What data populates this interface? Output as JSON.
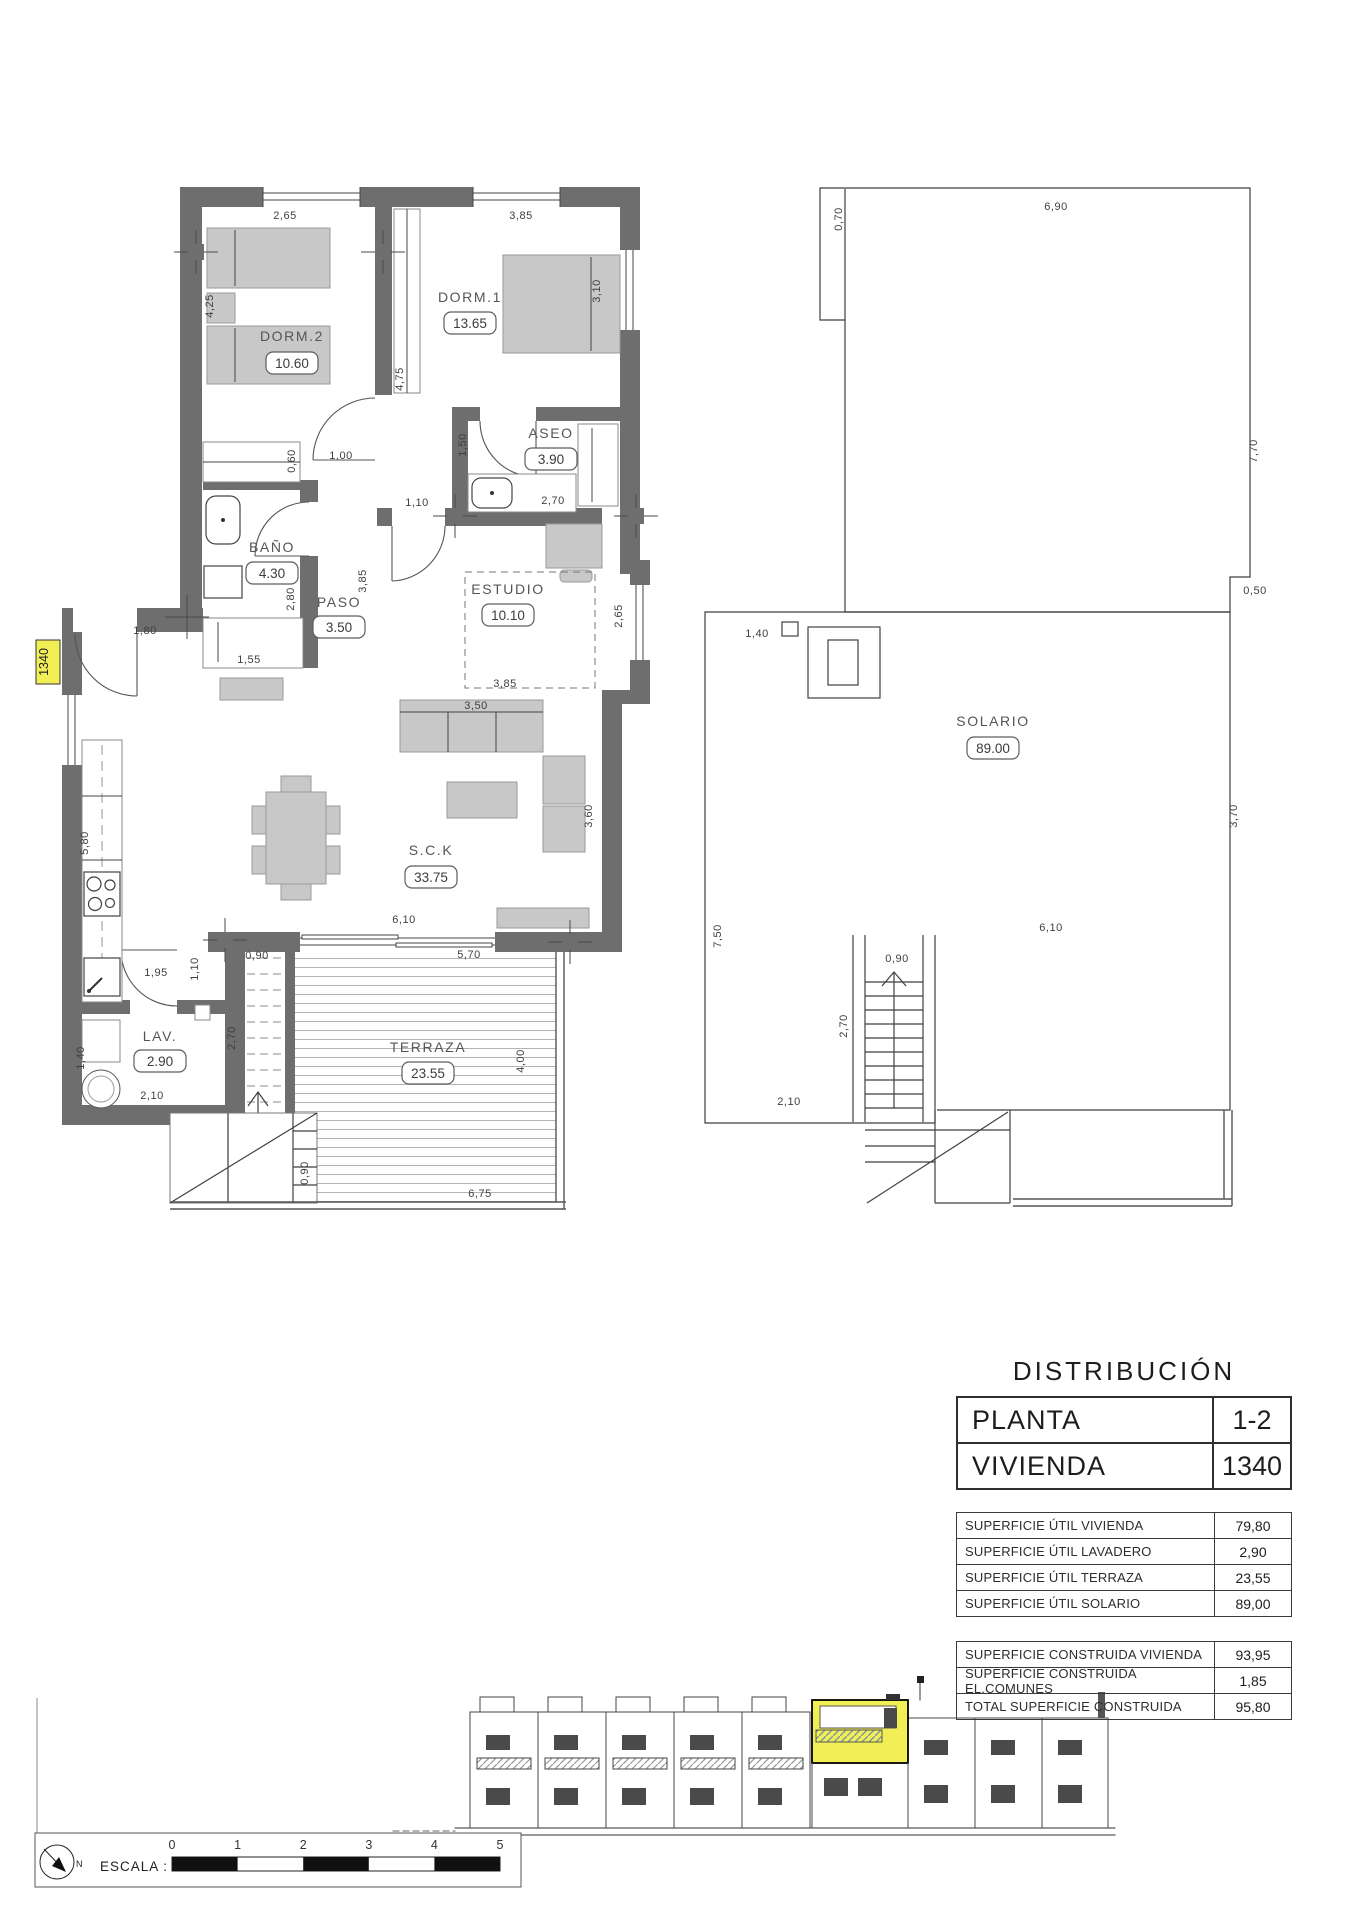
{
  "page": {
    "sheet_label": "1340"
  },
  "floor_plan": {
    "rooms": [
      {
        "name": "DORM.2",
        "area": "10.60"
      },
      {
        "name": "DORM.1",
        "area": "13.65"
      },
      {
        "name": "ASEO",
        "area": "3.90"
      },
      {
        "name": "BAÑO",
        "area": "4.30"
      },
      {
        "name": "PASO",
        "area": "3.50"
      },
      {
        "name": "ESTUDIO",
        "area": "10.10"
      },
      {
        "name": "S.C.K",
        "area": "33.75"
      },
      {
        "name": "LAV.",
        "area": "2.90"
      },
      {
        "name": "TERRAZA",
        "area": "23.55"
      }
    ],
    "dims": [
      "2,65",
      "3,85",
      "4,25",
      "4,75",
      "3,10",
      "0,60",
      "1,00",
      "1,50",
      "2,70",
      "1,10",
      "2,80",
      "3,85",
      "1,80",
      "1,55",
      "2,65",
      "3,85",
      "3,50",
      "3,60",
      "5,80",
      "1,95",
      "1,10",
      "0,90",
      "6,10",
      "5,70",
      "2,70",
      "1,40",
      "2,10",
      "0,90",
      "6,75",
      "4,00"
    ]
  },
  "solario_plan": {
    "room": {
      "name": "SOLARIO",
      "area": "89.00"
    },
    "dims": [
      "0,70",
      "6,90",
      "7,70",
      "0,50",
      "1,40",
      "3,70",
      "7,50",
      "6,10",
      "0,90",
      "2,70",
      "2,10"
    ]
  },
  "distribution": {
    "title": "DISTRIBUCIÓN",
    "header_rows": [
      {
        "label": "PLANTA",
        "value": "1-2"
      },
      {
        "label": "VIVIENDA",
        "value": "1340"
      }
    ],
    "util_rows": [
      {
        "label": "SUPERFICIE ÚTIL VIVIENDA",
        "value": "79,80"
      },
      {
        "label": "SUPERFICIE ÚTIL LAVADERO",
        "value": "2,90"
      },
      {
        "label": "SUPERFICIE ÚTIL TERRAZA",
        "value": "23,55"
      },
      {
        "label": "SUPERFICIE ÚTIL SOLARIO",
        "value": "89,00"
      }
    ],
    "built_rows": [
      {
        "label": "SUPERFICIE CONSTRUIDA VIVIENDA",
        "value": "93,95"
      },
      {
        "label": "SUPERFICIE CONSTRUIDA EL.COMUNES",
        "value": "1,85"
      },
      {
        "label": "TOTAL SUPERFICIE CONSTRUIDA",
        "value": "95,80"
      }
    ]
  },
  "scale_bar": {
    "label": "ESCALA :",
    "north_label": "N",
    "ticks": [
      "0",
      "1",
      "2",
      "3",
      "4",
      "5"
    ]
  },
  "colors": {
    "wall": "#6e6e6e",
    "furniture": "#c8c8c8",
    "hatch_line": "#b4b4b4",
    "highlight": "#f2ee55"
  }
}
